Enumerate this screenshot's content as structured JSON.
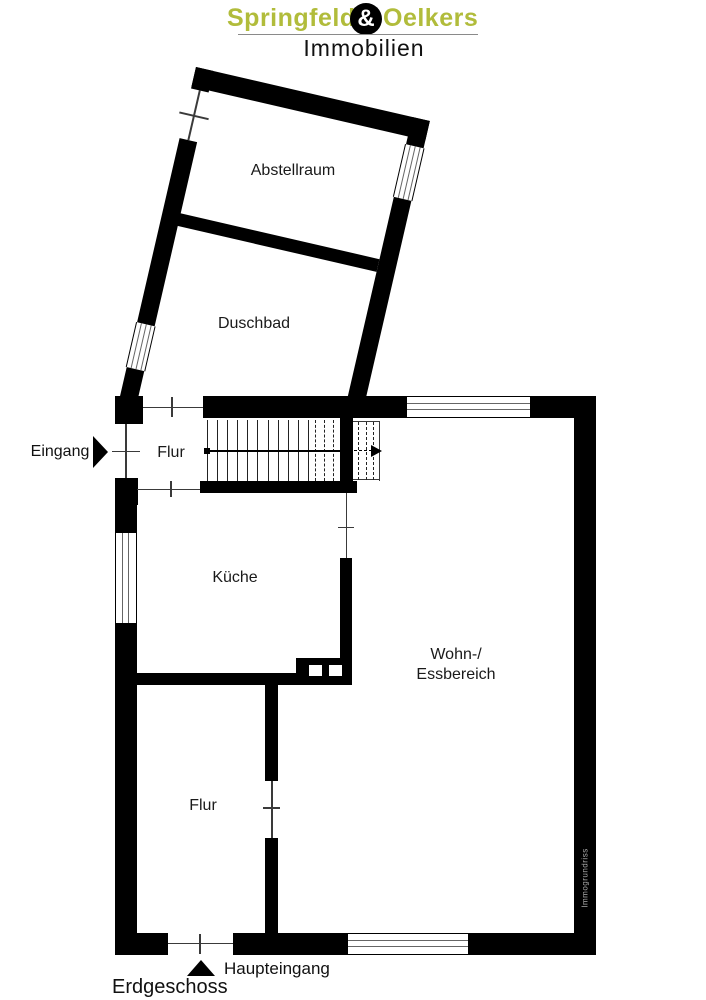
{
  "brand": {
    "name_left": "Springfeld",
    "ampersand": "&",
    "name_right": "Oelkers",
    "subtitle": "Immobilien"
  },
  "rooms": {
    "abstellraum": "Abstellraum",
    "duschbad": "Duschbad",
    "flur_upper": "Flur",
    "kueche": "Küche",
    "wohn_line1": "Wohn-/",
    "wohn_line2": "Essbereich",
    "flur_lower": "Flur"
  },
  "annotations": {
    "entrance_side": "Eingang",
    "entrance_main": "Haupteingang",
    "floor_label": "Erdgeschoss",
    "watermark": "Immogrundriss"
  },
  "colors": {
    "accent": "#b1bc3b",
    "wall": "#000000",
    "line": "#3a3a3a",
    "watermark": "#aaaaaa"
  }
}
